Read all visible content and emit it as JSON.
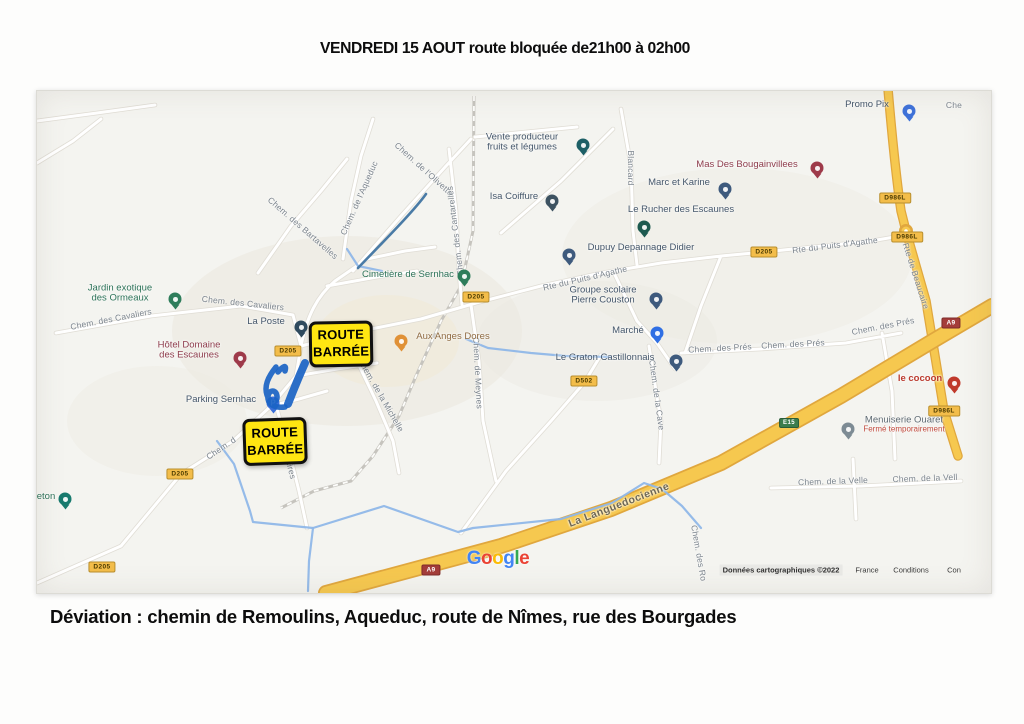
{
  "title": "VENDREDI 15 AOUT route bloquée de21h00 à 02h00",
  "caption": "Déviation : chemin de Remoulins, Aqueduc, route de Nîmes, rue des Bourgades",
  "colors": {
    "map_bg": "#f4f4f0",
    "road_casing": "#e0ddd5",
    "highway_yellow": "#f6c84f",
    "highway_casing": "#e0a73e",
    "stream_blue": "#8fb7e8",
    "scribble_blue": "#1a63c4",
    "accent_yellow_sign": "#ffe612",
    "badge_yellow_bg": "#f3bd4a",
    "badge_yellow_text": "#4a3a00",
    "badge_red_bg": "#a43d3a",
    "badge_green_bg": "#3b7d4d",
    "label_street": "#7b848d",
    "label_default": "#44566a",
    "label_green": "#2c7258",
    "label_red": "#8e3c4c",
    "label_bright_red": "#bb3a2e",
    "label_food": "#8f6b42",
    "label_gray": "#5f6b73",
    "closed_red": "#c14b3e"
  },
  "map": {
    "street_labels": [
      {
        "t": "Chem. des Bartavelles",
        "x": 266,
        "y": 137,
        "r": 41
      },
      {
        "t": "Chem. de l'Aqueduc",
        "x": 322,
        "y": 107,
        "r": -66
      },
      {
        "t": "Chem. de l'Olivette",
        "x": 387,
        "y": 78,
        "r": 42
      },
      {
        "t": "Chem. des Cantarelles",
        "x": 418,
        "y": 140,
        "r": -97
      },
      {
        "t": "Blancard",
        "x": 594,
        "y": 77,
        "r": 90
      },
      {
        "t": "Chem. des Cavaliers",
        "x": 74,
        "y": 228,
        "r": -11
      },
      {
        "t": "Chem. des Cavaliers",
        "x": 206,
        "y": 212,
        "r": 6
      },
      {
        "t": "Rte du Puits d'Agathe",
        "x": 548,
        "y": 187,
        "r": -13
      },
      {
        "t": "Rte du Puits d'Agathe",
        "x": 798,
        "y": 154,
        "r": -7
      },
      {
        "t": "Rte de Beaucaire",
        "x": 879,
        "y": 185,
        "r": 72
      },
      {
        "t": "Chem. de la Michelle",
        "x": 344,
        "y": 304,
        "r": 60
      },
      {
        "t": "Chem. de Meynes",
        "x": 441,
        "y": 282,
        "r": 87
      },
      {
        "t": "Chem. de la Cave",
        "x": 620,
        "y": 304,
        "r": 82
      },
      {
        "t": "Chem. des Prés",
        "x": 683,
        "y": 257,
        "r": -3
      },
      {
        "t": "Chem. des Prés",
        "x": 756,
        "y": 253,
        "r": -3
      },
      {
        "t": "Chem. des Prés",
        "x": 846,
        "y": 235,
        "r": -11
      },
      {
        "t": "Chem. de la Velle",
        "x": 796,
        "y": 390,
        "r": -2
      },
      {
        "t": "Chem. de la Vell",
        "x": 888,
        "y": 387,
        "r": -2
      },
      {
        "t": "La Languedocienne",
        "x": 582,
        "y": 414,
        "r": -21,
        "cls": "hwy"
      },
      {
        "t": "Chem. des Ro",
        "x": 662,
        "y": 462,
        "r": 80
      },
      {
        "t": "Chem. d",
        "x": 184,
        "y": 357,
        "r": -34
      },
      {
        "t": "Aires",
        "x": 254,
        "y": 378,
        "r": 76
      },
      {
        "t": "Che",
        "x": 917,
        "y": 14,
        "r": 0
      }
    ],
    "pois": [
      {
        "lines": [
          "Vente producteur",
          "fruits et légumes"
        ],
        "lx": 485,
        "ly": 52,
        "pin": {
          "x": 546,
          "y": 62,
          "c": "#1d5f66"
        }
      },
      {
        "lines": [
          "Isa Coiffure"
        ],
        "lx": 477,
        "ly": 106,
        "pin": {
          "x": 515,
          "y": 118,
          "c": "#3d5261"
        }
      },
      {
        "lines": [
          "Promo Pix"
        ],
        "lx": 830,
        "ly": 14,
        "pin": {
          "x": 872,
          "y": 28,
          "c": "#3f72d9"
        }
      },
      {
        "lines": [
          "Mas Des Bougainvillees"
        ],
        "lx": 710,
        "ly": 74,
        "cls": "maroon",
        "pin": {
          "x": 780,
          "y": 85,
          "c": "#9e3a4a"
        }
      },
      {
        "lines": [
          "Marc et Karine"
        ],
        "lx": 642,
        "ly": 92,
        "pin": {
          "x": 688,
          "y": 106,
          "c": "#3e5a7d"
        }
      },
      {
        "lines": [
          "Le Rucher des Escaunes"
        ],
        "lx": 644,
        "ly": 119,
        "pin": {
          "x": 607,
          "y": 144,
          "c": "#1d5a50"
        }
      },
      {
        "lines": [
          "Dupuy Depannage Didier"
        ],
        "lx": 604,
        "ly": 157,
        "pin": {
          "x": 532,
          "y": 172,
          "c": "#3e5a7d"
        }
      },
      {
        "lines": [
          "Jardin exotique",
          "des Ormeaux"
        ],
        "lx": 83,
        "ly": 203,
        "cls": "green",
        "pin": {
          "x": 138,
          "y": 216,
          "c": "#2e7d5b"
        }
      },
      {
        "lines": [
          "Cimetière de Sernhac"
        ],
        "lx": 371,
        "ly": 184,
        "cls": "green",
        "pin": {
          "x": 427,
          "y": 193,
          "c": "#2e7d5b"
        }
      },
      {
        "lines": [
          "La Poste"
        ],
        "lx": 229,
        "ly": 231,
        "pin": {
          "x": 264,
          "y": 244,
          "c": "#2f4a5e"
        }
      },
      {
        "lines": [
          "Hôtel Domaine",
          "des Escaunes"
        ],
        "lx": 152,
        "ly": 260,
        "cls": "maroon",
        "pin": {
          "x": 203,
          "y": 275,
          "c": "#9e3a4a"
        }
      },
      {
        "lines": [
          "Aux Anges Dores"
        ],
        "lx": 416,
        "ly": 246,
        "cls": "food",
        "pin": {
          "x": 364,
          "y": 258,
          "c": "#e09137"
        }
      },
      {
        "lines": [
          "Groupe scolaire",
          "Pierre Couston"
        ],
        "lx": 566,
        "ly": 205,
        "pin": {
          "x": 619,
          "y": 216,
          "c": "#3e5a7d"
        }
      },
      {
        "lines": [
          "Marché"
        ],
        "lx": 591,
        "ly": 240,
        "pin": {
          "x": 620,
          "y": 250,
          "c": "#2f6fe4"
        }
      },
      {
        "lines": [
          "Le Graton Castillonnais"
        ],
        "lx": 568,
        "ly": 267,
        "pin": {
          "x": 639,
          "y": 278,
          "c": "#3e5a7d"
        }
      },
      {
        "lines": [
          "le cocoon"
        ],
        "lx": 883,
        "ly": 288,
        "cls": "brightred",
        "pin": {
          "x": 917,
          "y": 300,
          "c": "#c0392b"
        }
      },
      {
        "lines": [
          "Menuiserie Ouaret"
        ],
        "sub": "Fermé temporairement",
        "lx": 867,
        "ly": 334,
        "cls": "gray",
        "pin": {
          "x": 811,
          "y": 346,
          "c": "#7d8b94"
        }
      },
      {
        "lines": [
          "Parking Sernhac"
        ],
        "lx": 184,
        "ly": 309,
        "pin": {
          "x": 236,
          "y": 320,
          "c": "#3a6fd8",
          "g": "P"
        }
      },
      {
        "lines": [
          "eton"
        ],
        "lx": 9,
        "ly": 406,
        "cls": "green",
        "pin": {
          "x": 28,
          "y": 416,
          "c": "#177a6e"
        }
      }
    ],
    "badges": [
      {
        "t": "D205",
        "x": 439,
        "y": 206
      },
      {
        "t": "D205",
        "x": 251,
        "y": 260
      },
      {
        "t": "D205",
        "x": 727,
        "y": 161
      },
      {
        "t": "D205",
        "x": 143,
        "y": 383
      },
      {
        "t": "D205",
        "x": 65,
        "y": 476
      },
      {
        "t": "D986L",
        "x": 858,
        "y": 107
      },
      {
        "t": "D986L",
        "x": 870,
        "y": 146
      },
      {
        "t": "D986L",
        "x": 907,
        "y": 320
      },
      {
        "t": "D502",
        "x": 547,
        "y": 290
      },
      {
        "t": "A9",
        "x": 394,
        "y": 479,
        "type": "a"
      },
      {
        "t": "A9",
        "x": 914,
        "y": 232,
        "type": "a"
      },
      {
        "t": "E15",
        "x": 752,
        "y": 332,
        "type": "e"
      }
    ],
    "signs": [
      {
        "l1": "ROUTE",
        "l2": "BARRÉE",
        "x": 272,
        "y": 230,
        "w": 58,
        "h": 40,
        "r": -1
      },
      {
        "l1": "ROUTE",
        "l2": "BARRÉE",
        "x": 206,
        "y": 327,
        "w": 58,
        "h": 41,
        "r": -2
      }
    ],
    "google_logo": {
      "x": 461,
      "y": 468,
      "letters": [
        [
          "G",
          "#4285F4"
        ],
        [
          "o",
          "#EA4335"
        ],
        [
          "o",
          "#FBBC05"
        ],
        [
          "g",
          "#4285F4"
        ],
        [
          "l",
          "#34A853"
        ],
        [
          "e",
          "#EA4335"
        ]
      ]
    },
    "attribution": {
      "y": 479,
      "items": [
        {
          "t": "Données cartographiques ©2022",
          "x": 744,
          "boxed": true
        },
        {
          "t": "France",
          "x": 830
        },
        {
          "t": "Conditions",
          "x": 874
        },
        {
          "t": "Con",
          "x": 917
        }
      ]
    }
  }
}
